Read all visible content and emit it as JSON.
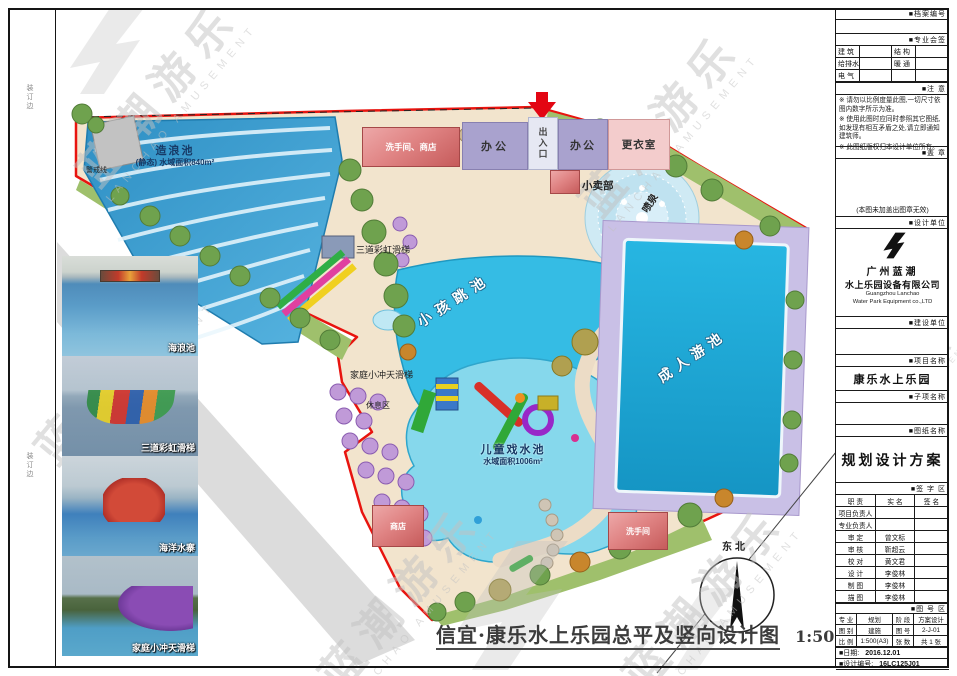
{
  "watermark": {
    "cn": "蓝潮游乐",
    "en": "LANCHAO AMUSEMENT"
  },
  "margin": {
    "binding1": "装订边",
    "binding2": "装订边"
  },
  "photos": {
    "items": [
      {
        "caption": "海浪池"
      },
      {
        "caption": "三道彩虹滑梯"
      },
      {
        "caption": "海洋水寨"
      },
      {
        "caption": "家庭小冲天滑梯"
      }
    ]
  },
  "plan": {
    "wave_pool_name": "造浪池",
    "wave_pool_area": "(静态) 水域面积840m²",
    "warning_line": "警戒线",
    "toilet_shop": "洗手间、商店",
    "office_a": "办公",
    "office_b": "办公",
    "entrance": "出入口",
    "changing_room": "更衣室",
    "kiosk": "小卖部",
    "fountain": "喷泉",
    "rainbow_slide": "三道彩虹滑梯",
    "kids_jump_pool": "小孩跳池",
    "family_slide": "家庭小冲天滑梯",
    "rest_area": "休息区",
    "children_pool_name": "儿童戏水池",
    "children_pool_area": "水域面积1006m²",
    "adult_pool": "成人游池",
    "shop": "商店",
    "toilet": "洗手间",
    "north": "东北",
    "title": "信宜·康乐水上乐园总平及竖向设计图",
    "scale": "1:500"
  },
  "titleblock": {
    "archive_label": "■档案编号",
    "sign_band": "■专业会签",
    "disciplines": [
      [
        "建 筑",
        "结 构"
      ],
      [
        "给排水",
        "暖 通"
      ],
      [
        "电 气",
        ""
      ]
    ],
    "notes_band": "■注 意",
    "notes": [
      "※ 请勿以比例度量此图,一切尺寸依图内数字所示为准。",
      "※ 使用此图时应同时参照其它图纸,如发现有相互矛盾之处,请立即通知建筑师。",
      "※ 此图纸版权归本设计单位所有。"
    ],
    "stamp_band": "■盖 章",
    "stamp_note": "(本图未加盖出图章无效)",
    "designer_band": "■设计单位",
    "company_cn1": "广州蓝潮",
    "company_cn2": "水上乐园设备有限公司",
    "company_en1": "Guangzhou Lanchao",
    "company_en2": "Water Park Equipment co.,LTD",
    "owner_band": "■建设单位",
    "project_band": "■项目名称",
    "project_name": "康乐水上乐园",
    "subproject_band": "■子项名称",
    "drawing_band": "■图纸名称",
    "drawing_name": "规划设计方案",
    "signature_band": "■签 字 区",
    "sig_header": [
      "职 责",
      "实 名",
      "签 名"
    ],
    "sig_rows": [
      [
        "项目负责人",
        "",
        ""
      ],
      [
        "专业负责人",
        "",
        ""
      ],
      [
        "审 定",
        "曾文标",
        ""
      ],
      [
        "审 核",
        "靳超云",
        ""
      ],
      [
        "校 对",
        "黄文君",
        ""
      ],
      [
        "设 计",
        "李俊林",
        ""
      ],
      [
        "制 图",
        "李俊林",
        ""
      ],
      [
        "描 图",
        "李俊林",
        ""
      ]
    ],
    "number_band": "■图 号 区",
    "num_rows": [
      [
        "专 业",
        "规划",
        "阶 段",
        "方案设计"
      ],
      [
        "图 别",
        "建施",
        "图 号",
        "2-J-01"
      ],
      [
        "比 例",
        "1:500(A3)",
        "张 数",
        "共 1 张"
      ]
    ],
    "date_label": "■日期:",
    "date_value": "2016.12.01",
    "designno_label": "■设计编号:",
    "designno_value": "16LC125J01"
  }
}
